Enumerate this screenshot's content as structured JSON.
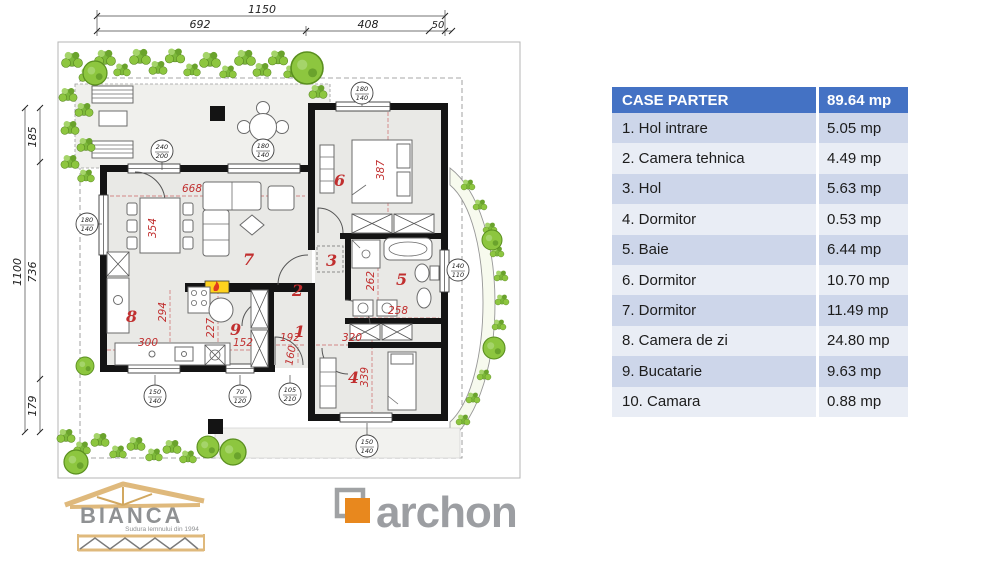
{
  "plan": {
    "dims_top": {
      "total": "1150",
      "seg1": "692",
      "seg2": "408",
      "seg3": "50"
    },
    "dims_left": {
      "total": "1100",
      "seg1": "185",
      "seg2": "736",
      "seg3": "179"
    },
    "red_dims": {
      "living_w": "668",
      "dining_table": "354",
      "bed6": "387",
      "kitchen_h": "294",
      "k300": "300",
      "k227": "227",
      "k152": "152",
      "h192": "192",
      "h160": "160",
      "c320": "320",
      "bed4": "339",
      "bath_h": "262",
      "bath_w": "258"
    },
    "rooms": {
      "r1": "1",
      "r2": "2",
      "r3": "3",
      "r4": "4",
      "r5": "5",
      "r6": "6",
      "r7": "7",
      "r8": "8",
      "r9": "9"
    },
    "markers": {
      "terrace_door": {
        "top": "240",
        "bottom": "200"
      },
      "terrace_table": {
        "top": "180",
        "bottom": "140"
      },
      "room6_window": {
        "top": "180",
        "bottom": "140"
      },
      "left_window": {
        "top": "180",
        "bottom": "140"
      },
      "bottom_window": {
        "top": "150",
        "bottom": "140"
      },
      "bottom_small": {
        "top": "70",
        "bottom": "120"
      },
      "entry_door": {
        "top": "105",
        "bottom": "210"
      },
      "room4_window": {
        "top": "150",
        "bottom": "140"
      },
      "bath_window": {
        "top": "140",
        "bottom": "110"
      }
    }
  },
  "table": {
    "header": {
      "label": "CASE PARTER",
      "value": "89.64 mp"
    },
    "rows": [
      {
        "name": "1. Hol intrare",
        "area": "5.05 mp"
      },
      {
        "name": "2. Camera tehnica",
        "area": "4.49 mp"
      },
      {
        "name": "3. Hol",
        "area": "5.63 mp"
      },
      {
        "name": "4. Dormitor",
        "area": "0.53 mp"
      },
      {
        "name": "5. Baie",
        "area": "6.44 mp"
      },
      {
        "name": "6. Dormitor",
        "area": "10.70 mp"
      },
      {
        "name": "7. Dormitor",
        "area": "11.49 mp"
      },
      {
        "name": "8. Camera de zi",
        "area": "24.80 mp"
      },
      {
        "name": "9. Bucatarie",
        "area": "9.63 mp"
      },
      {
        "name": "10. Camara",
        "area": "0.88 mp"
      }
    ]
  },
  "logos": {
    "bianca": {
      "name": "BIANCA",
      "tagline": "Sudura lemnului din 1994"
    },
    "archon": {
      "name": "archon"
    }
  },
  "colors": {
    "accent_blue": "#4472c4",
    "row_light": "#cdd6ea",
    "row_lighter": "#e9edf5",
    "dim_red": "#c12f2f",
    "plant_green": "#8dc63f",
    "logo_orange": "#e8881e",
    "logo_gray": "#9c9ea2"
  }
}
